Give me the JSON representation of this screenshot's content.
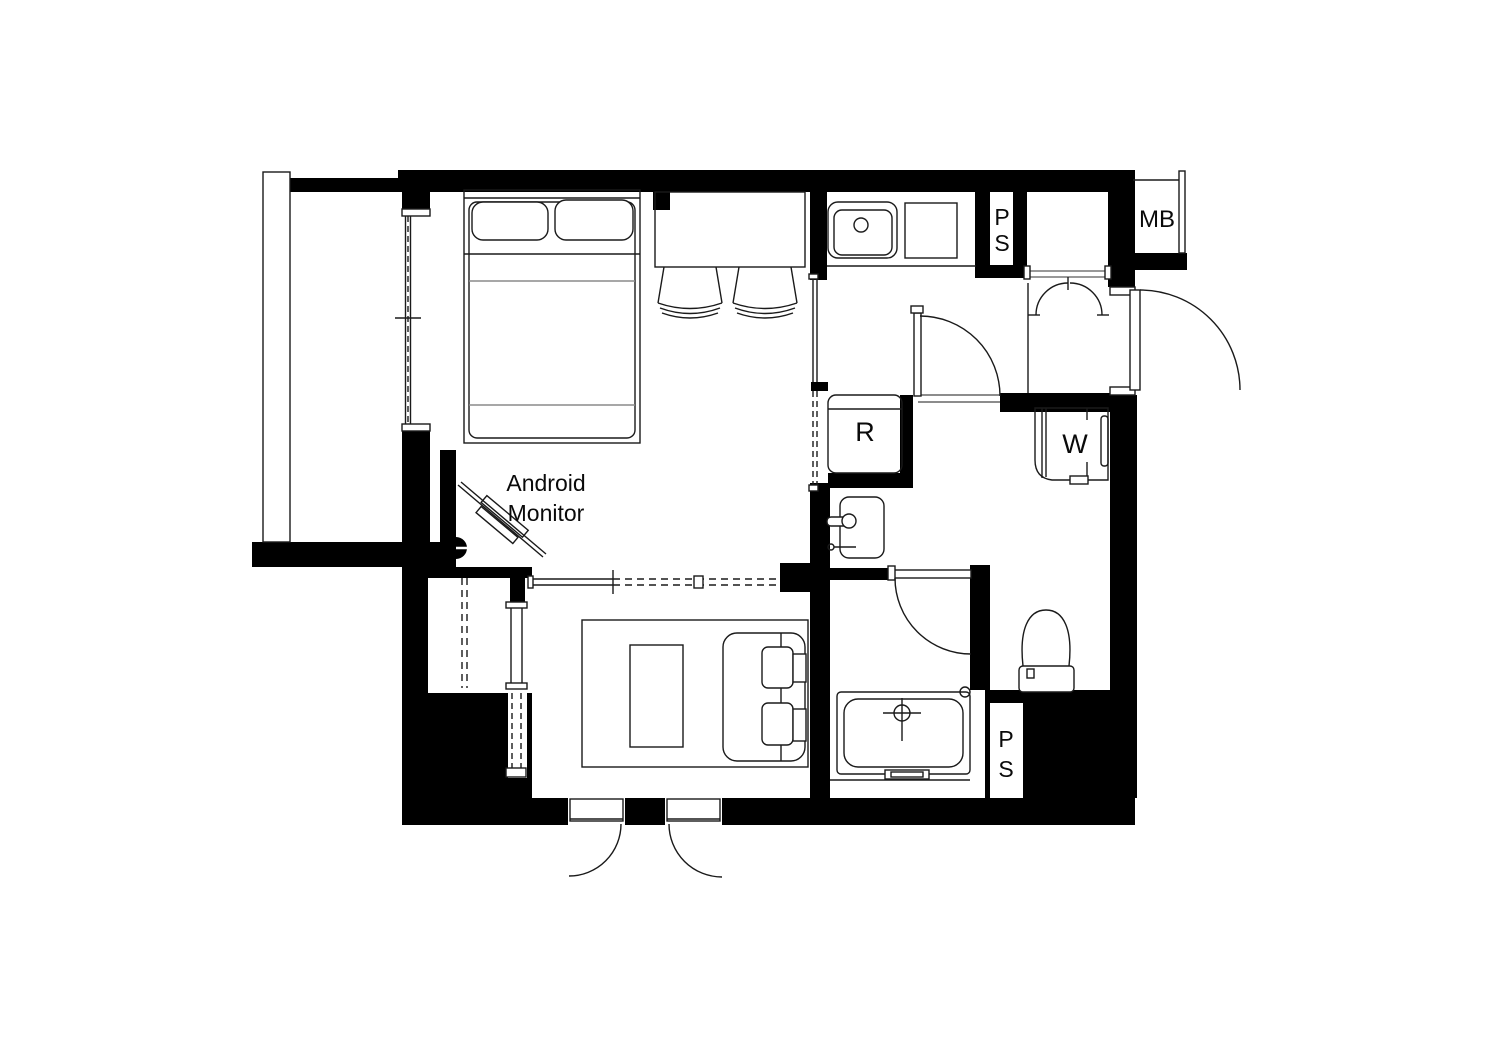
{
  "labels": {
    "pipe_shaft_top": "PS",
    "meter_box": "MB",
    "refrigerator": "R",
    "washing_machine": "W",
    "monitor_note": "Android Monitor",
    "pipe_shaft_bottom": "PS"
  },
  "colors": {
    "wall": "#000000",
    "line": "#1a1a1a",
    "background": "#ffffff",
    "text": "#0a0a0a"
  }
}
